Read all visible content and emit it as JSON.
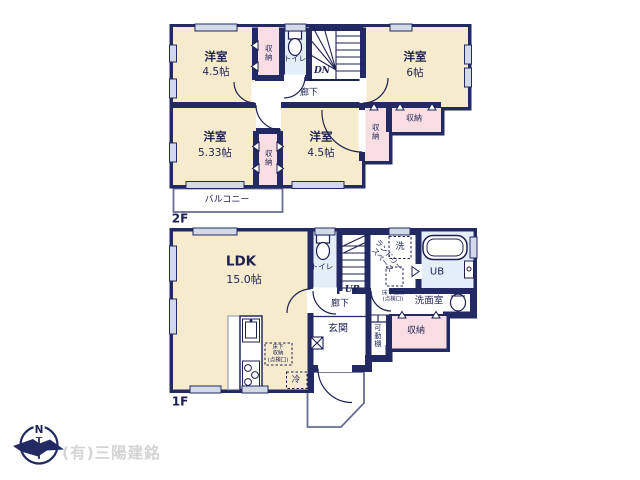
{
  "floor2": {
    "label": "2F",
    "bedroom_nw": {
      "name": "洋室",
      "size": "4.5帖"
    },
    "bedroom_ne": {
      "name": "洋室",
      "size": "6帖"
    },
    "bedroom_sw": {
      "name": "洋室",
      "size": "5.33帖"
    },
    "bedroom_s": {
      "name": "洋室",
      "size": "4.5帖"
    },
    "closet_nw": "収納",
    "closet_mid": "収納",
    "closet_e_vertical": "収納",
    "closet_e_horizontal": "収納",
    "toilet": "トイレ",
    "stairs": "DN",
    "hallway": "廊下",
    "balcony": "バルコニー"
  },
  "floor1": {
    "label": "1F",
    "ldk": {
      "name": "LDK",
      "size": "15.0帖"
    },
    "toilet": "トイレ",
    "stairs": "UP",
    "hallway": "廊下",
    "laundry": {
      "line1": "ランドリー",
      "line2": "スペース"
    },
    "washer": "洗",
    "bath": "UB",
    "washroom": "洗面室",
    "underfloor_hatch": {
      "line1": "床下収納",
      "line2": "(点検口)"
    },
    "ldk_hatch": {
      "line1": "床下",
      "line2": "収納",
      "line3": "(点検口)"
    },
    "closet": "収納",
    "shelf": "可動棚",
    "entrance": "玄関",
    "fridge": "冷"
  },
  "footer": {
    "company": "(有)三陽建銘",
    "north": "N"
  },
  "colors": {
    "wall": "#232a63",
    "room_cream": "#f7ebcd",
    "closet_pink": "#f8dde3",
    "wet_blue": "#e3eef8",
    "window_gray": "#d2d9e7",
    "watermark_gray": "#d4d4d4"
  }
}
